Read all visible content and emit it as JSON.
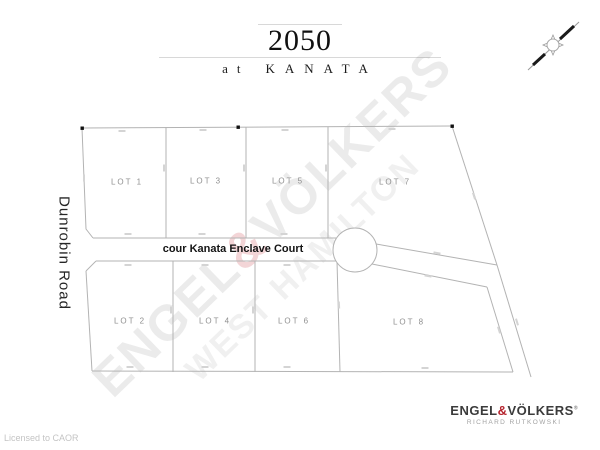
{
  "title": {
    "number": "2050",
    "prefix": "at",
    "name": "KANATA"
  },
  "side_road": "Dunrobin Road",
  "street": "cour Kanata Enclave Court",
  "plan": {
    "lots": [
      {
        "label": "LOT 1"
      },
      {
        "label": "LOT 2"
      },
      {
        "label": "LOT 3"
      },
      {
        "label": "LOT 4"
      },
      {
        "label": "LOT 5"
      },
      {
        "label": "LOT 6"
      },
      {
        "label": "LOT 7"
      },
      {
        "label": "LOT 8"
      }
    ]
  },
  "watermark": {
    "brand_left": "ENGEL",
    "amp": "&",
    "brand_right": "VÖLKERS",
    "secondary": "WEST HAMILTON"
  },
  "logo": {
    "brand_left": "ENGEL",
    "amp": "&",
    "brand_right": "VÖLKERS",
    "reg_mark": "®",
    "agent": "RICHARD RUTKOWSKI"
  },
  "footer": {
    "license": "Licensed to CAOR"
  },
  "colors": {
    "plan_line": "#b3b3b3",
    "accent_red": "#b5242e",
    "label_gray": "#8f8f8f"
  }
}
